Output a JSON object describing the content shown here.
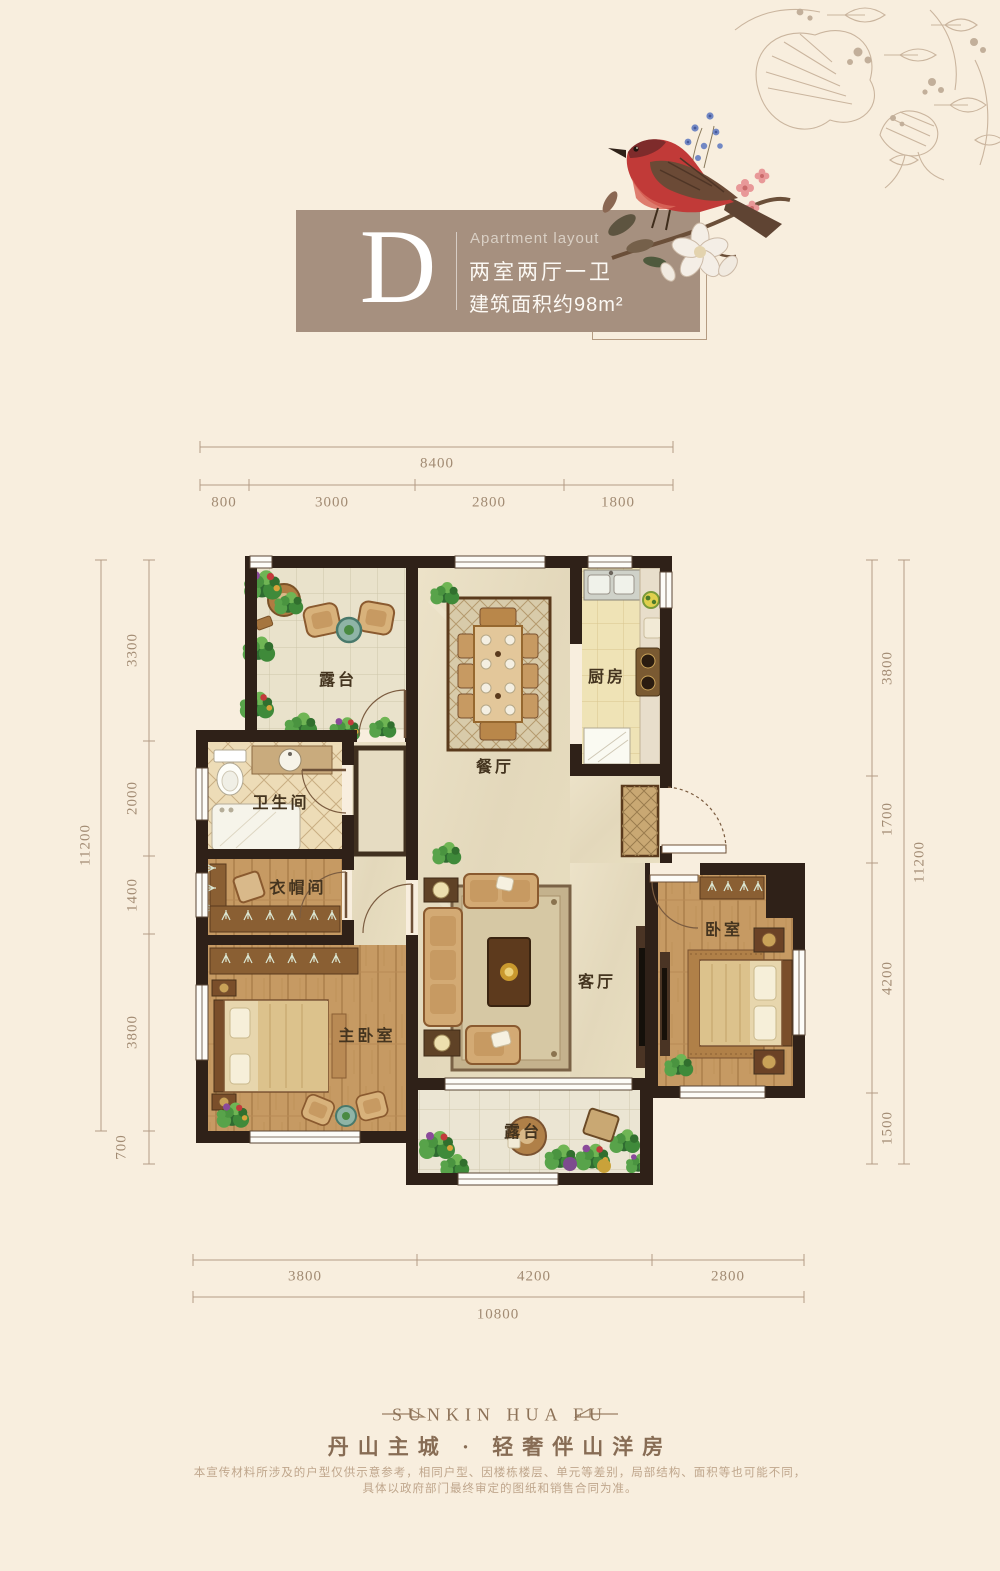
{
  "title": {
    "plan_letter": "D",
    "subtitle_en": "Apartment layout",
    "layout_cn": "两室两厅一卫",
    "area_cn": "建筑面积约98m²"
  },
  "plan": {
    "rooms": [
      {
        "id": "terrace-top",
        "label": "露台"
      },
      {
        "id": "dining-room",
        "label": "餐厅"
      },
      {
        "id": "kitchen",
        "label": "厨房"
      },
      {
        "id": "bathroom",
        "label": "卫生间"
      },
      {
        "id": "cloakroom",
        "label": "衣帽间"
      },
      {
        "id": "master-bedroom",
        "label": "主卧室"
      },
      {
        "id": "living-room",
        "label": "客厅"
      },
      {
        "id": "bedroom",
        "label": "卧室"
      },
      {
        "id": "terrace-bottom",
        "label": "露台"
      }
    ],
    "dimensions": {
      "top": {
        "total": "8400",
        "segments": [
          "800",
          "3000",
          "2800",
          "1800"
        ]
      },
      "left": {
        "total": "11200",
        "segments": [
          "3300",
          "2000",
          "1400",
          "3800",
          "700"
        ]
      },
      "right": {
        "total": "11200",
        "segments": [
          "3800",
          "1700",
          "4200",
          "1500"
        ]
      },
      "bottom": {
        "total": "10800",
        "segments": [
          "3800",
          "4200",
          "2800"
        ]
      }
    }
  },
  "footer": {
    "brand": "SUNKIN HUA FU",
    "tagline": "丹山主城 · 轻奢伴山洋房",
    "disclaimer_line1": "本宣传材料所涉及的户型仅供示意参考，相同户型、因楼栋楼层、单元等差别，局部结构、面积等也可能不同，",
    "disclaimer_line2": "具体以政府部门最终审定的图纸和销售合同为准。"
  },
  "colors": {
    "background": "#f8eede",
    "title_card": "#a6907f",
    "wall": "#2f2118",
    "dimension_text": "#a28b73",
    "brand_text": "#8d7258"
  }
}
